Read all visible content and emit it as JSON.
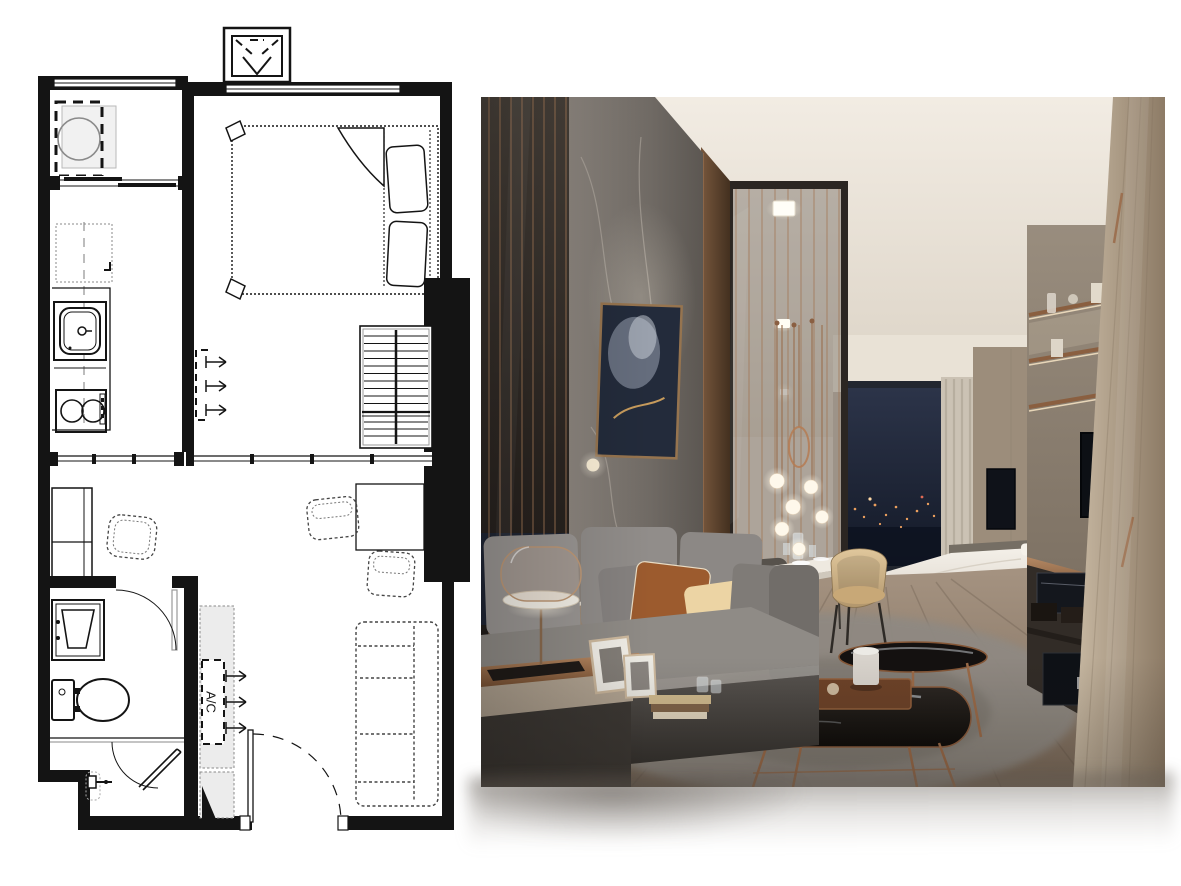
{
  "page": {
    "background": "#ffffff"
  },
  "floor_plan": {
    "ac_label": "A/C",
    "ink": "#141414",
    "paper": "#ffffff",
    "fixtures": [
      "ac-condenser-unit",
      "window-band",
      "washing-machine",
      "laundry-sliding-door",
      "refrigerator",
      "kitchen-counter",
      "kitchen-sink",
      "two-burner-stove",
      "double-bed",
      "bed-pillows",
      "wardrobe",
      "bedroom-ac-unit",
      "glass-partition",
      "structural-column",
      "dresser",
      "stool",
      "dining-table",
      "dining-chair",
      "sofa",
      "entrance-door",
      "built-in-cabinet",
      "living-ac-unit",
      "bathroom-door",
      "bathroom-sink",
      "toilet",
      "shower-screen",
      "shower-mixer"
    ]
  },
  "render_photo": {
    "objects": [
      "smoked-glass-wall-copper-lines",
      "marble-feature-wall",
      "abstract-artwork",
      "pendant-globe-lights",
      "ring-pendant",
      "recessed-downlights",
      "night-city-window",
      "sheer-curtain",
      "bedroom-tv",
      "living-tv",
      "white-bed",
      "dining-table-set",
      "beige-armchair",
      "dark-dining-chair",
      "gray-sofa",
      "accent-pillows",
      "dome-table-lamp",
      "picture-frames",
      "books",
      "copper-side-table",
      "copper-coffee-tables",
      "wooden-tray",
      "canister",
      "shag-rug",
      "wood-floor",
      "shelf-wall-unit",
      "media-console",
      "wood-wardrobe-panel"
    ],
    "palette": {
      "ceiling": "#efe9e0",
      "marble": "#847d76",
      "copper": "#a1714d",
      "glass_dark": "#2a2522",
      "window_night": "#1c2333",
      "city_light": "#eda966",
      "curtain": "#c9c0b2",
      "wood_floor": "#9a8671",
      "rug": "#928c84",
      "sofa_gray": "#8f8b88",
      "pillow_rust": "#9d5c31",
      "pillow_cream": "#ead2a2",
      "duvet": "#eee9e1",
      "cabinet_wood": "#b7a791",
      "tv_black": "#10131a"
    }
  }
}
